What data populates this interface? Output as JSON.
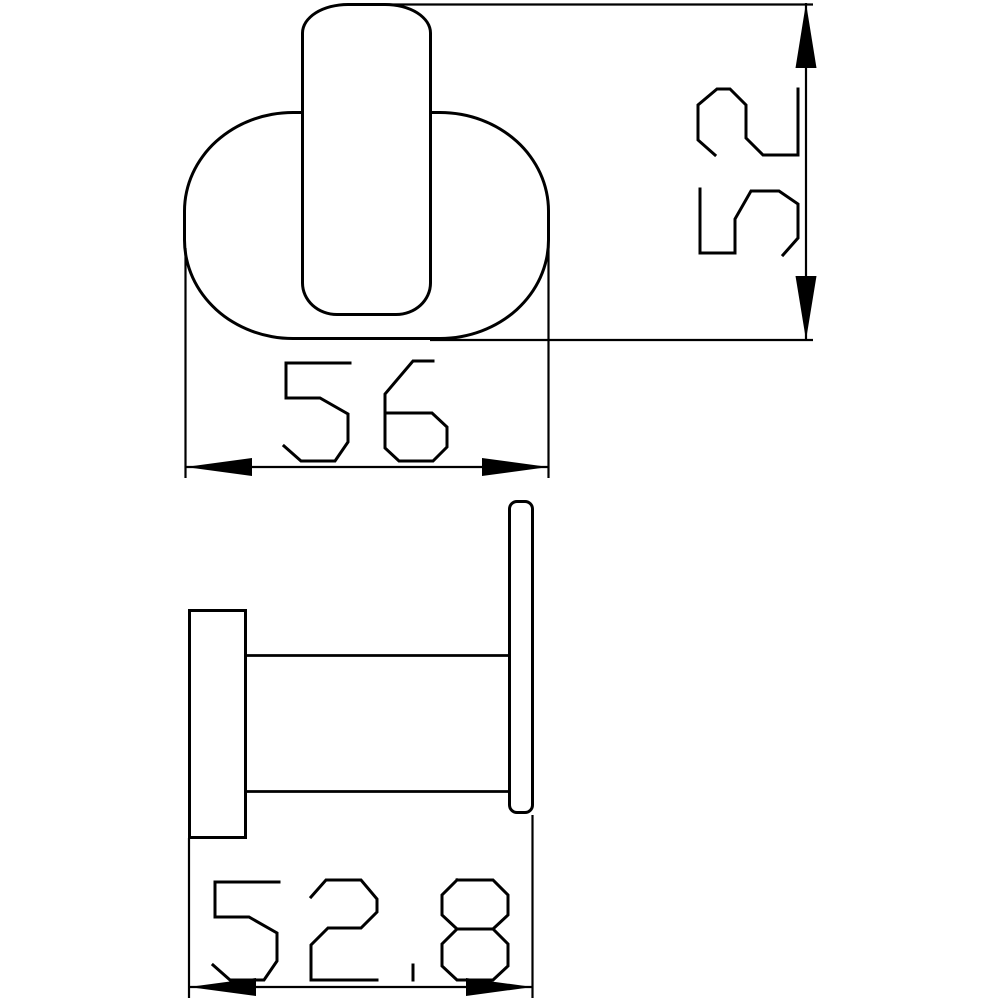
{
  "canvas": {
    "background_color": "#ffffff",
    "line_color": "#000000"
  },
  "views": {
    "front": {
      "dimensions": {
        "width": {
          "value": "56"
        },
        "height": {
          "value": "52"
        }
      }
    },
    "side": {
      "dimensions": {
        "depth": {
          "value": "52.8"
        }
      }
    }
  }
}
